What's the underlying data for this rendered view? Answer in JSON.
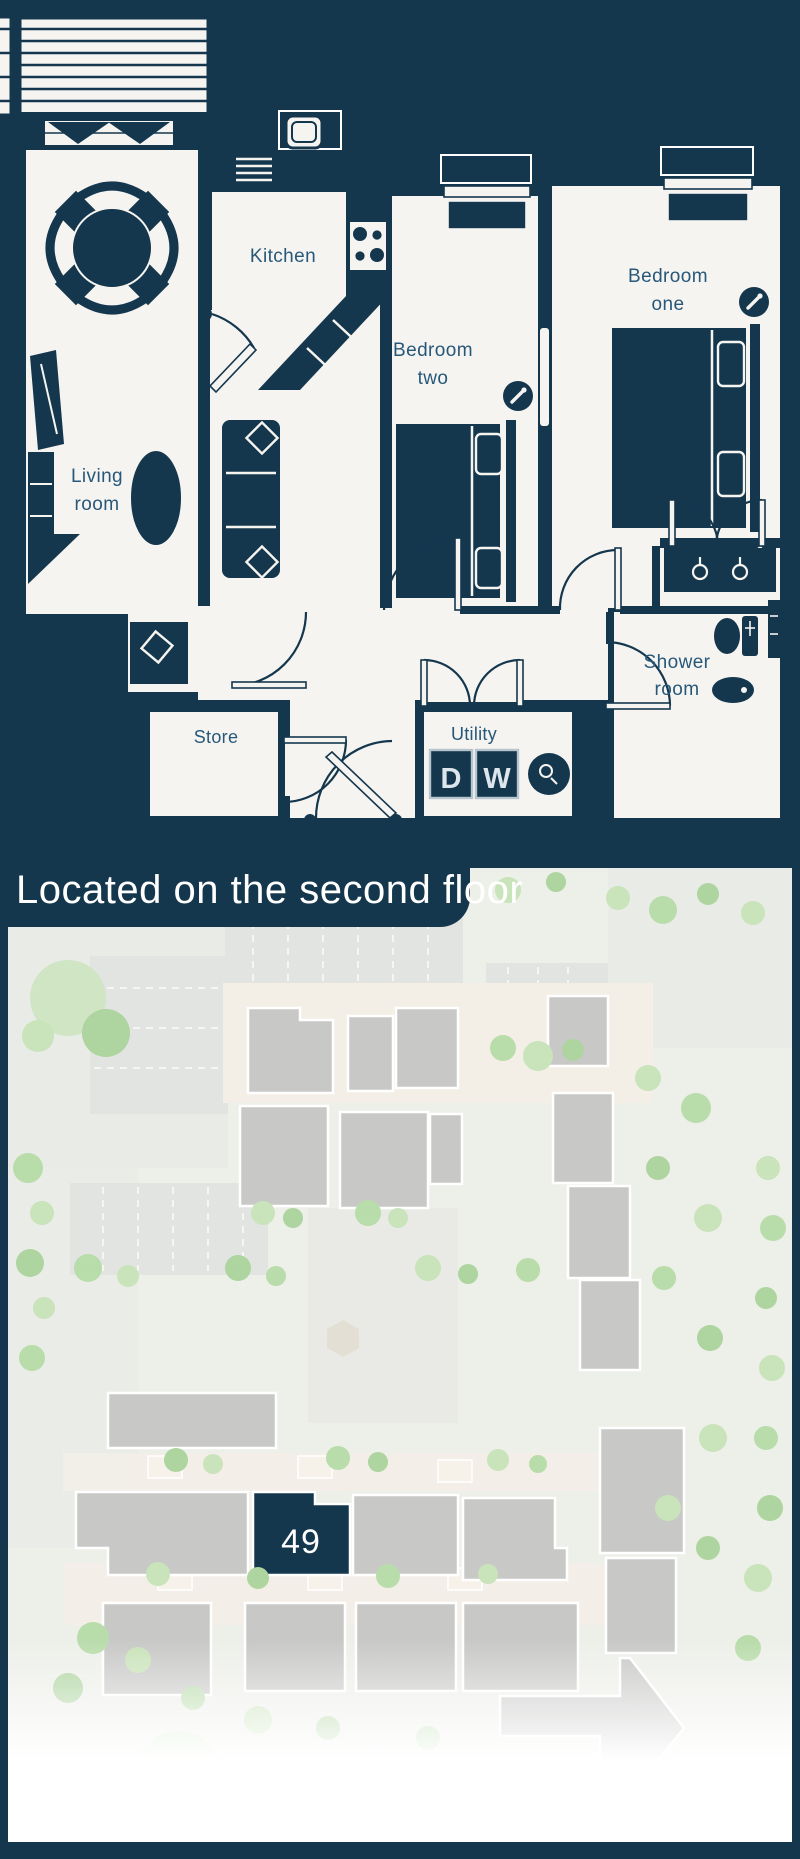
{
  "banner": {
    "title": "Located on the second floor"
  },
  "floorplan": {
    "rooms": {
      "kitchen": {
        "label": "Kitchen"
      },
      "living": {
        "line1": "Living",
        "line2": "room"
      },
      "bedroom_two": {
        "line1": "Bedroom",
        "line2": "two"
      },
      "bedroom_one": {
        "line1": "Bedroom",
        "line2": "one"
      },
      "shower": {
        "line1": "Shower",
        "line2": "room"
      },
      "store": {
        "label": "Store"
      },
      "utility": {
        "label": "Utility"
      }
    },
    "appliances": {
      "dishwasher_label": "D",
      "washing_machine_label": "W"
    }
  },
  "siteplan": {
    "highlighted_unit": "49"
  },
  "colors": {
    "navy": "#14374e",
    "floor_white": "#f6f4f0",
    "label_blue": "#27587a",
    "building_gray": "#c8c9c7",
    "tree_green": "#b9dcab",
    "banner_text": "#ffffff",
    "highlight_unit": "#14374e"
  }
}
